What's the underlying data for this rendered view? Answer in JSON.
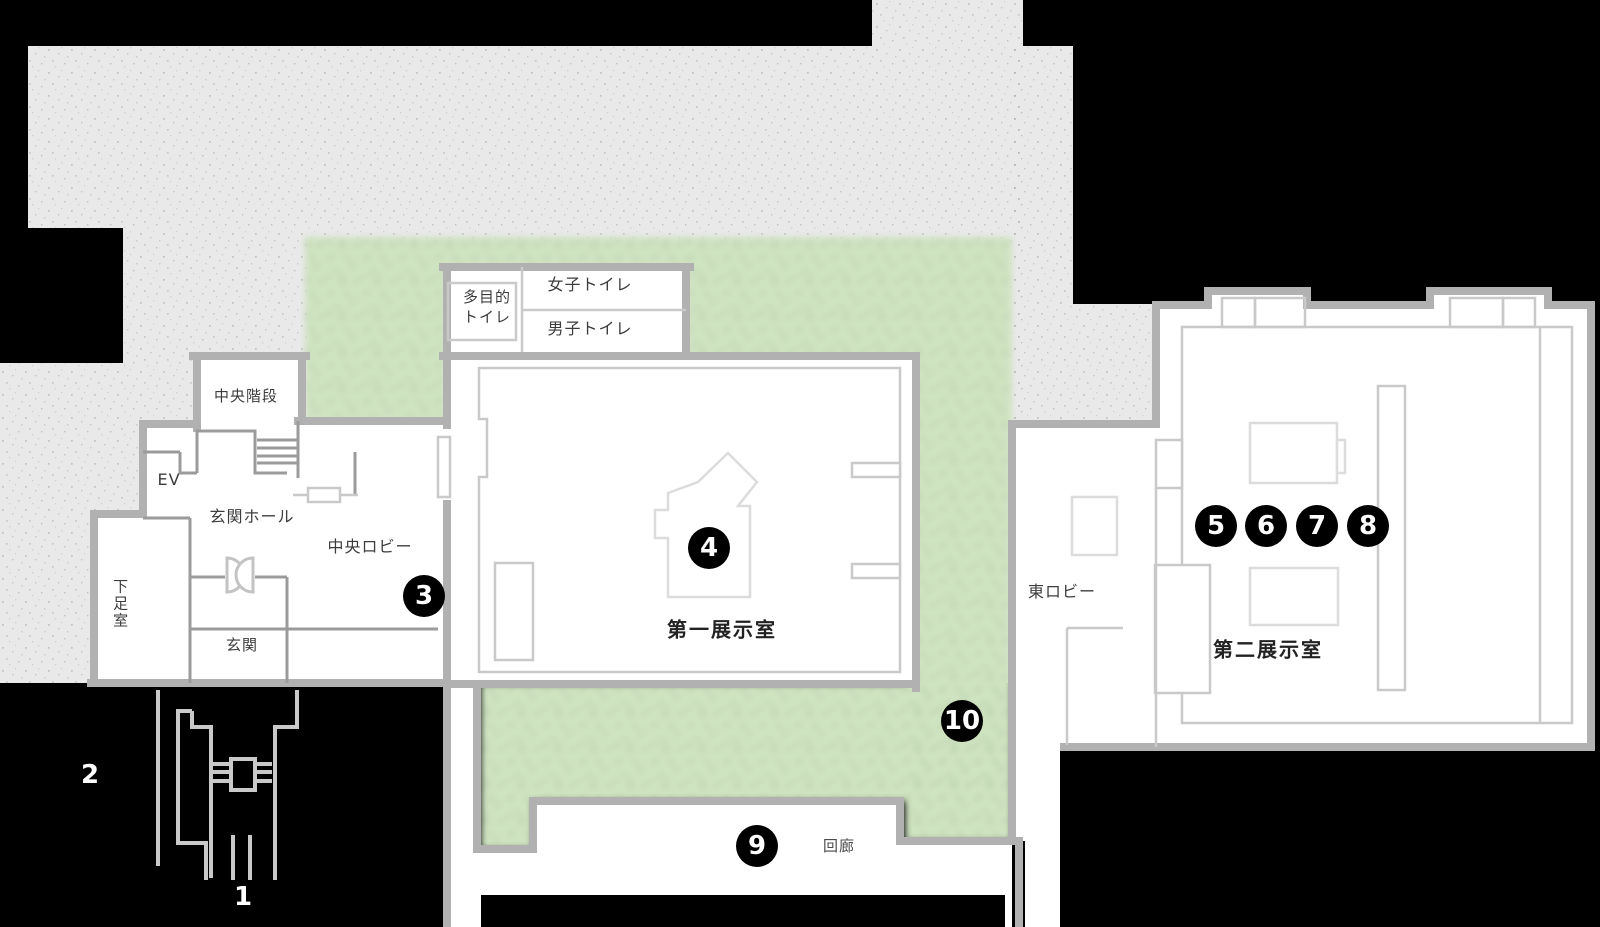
{
  "map": {
    "kind": "museum-floor-plan",
    "colors": {
      "background": "#000000",
      "grounds": "#e9e9e9",
      "garden": "#cfe3c1",
      "wall": "#b1b1b1",
      "thin_wall": "#9b9b9b",
      "light_line": "#d9d9d9",
      "marker_bg": "#000000",
      "marker_text": "#ffffff",
      "label_text": "#3c3c3c"
    }
  },
  "rooms": {
    "multipurpose_toilet": {
      "line1": "多目的",
      "line2": "トイレ"
    },
    "womens_toilet": "女子トイレ",
    "mens_toilet": "男子トイレ",
    "central_stairs": "中央階段",
    "elevator": "EV",
    "entrance_hall": "玄関ホール",
    "shoe_room": "下足室",
    "entrance": "玄関",
    "central_lobby": "中央ロビー",
    "exhibition_room_1": "第一展示室",
    "east_lobby": "東ロビー",
    "exhibition_room_2": "第二展示室",
    "corridor": "回廊"
  },
  "markers": [
    {
      "label": "1",
      "style": "plain"
    },
    {
      "label": "2",
      "style": "plain"
    },
    {
      "label": "3",
      "style": "circle"
    },
    {
      "label": "4",
      "style": "circle"
    },
    {
      "label": "5",
      "style": "circle"
    },
    {
      "label": "6",
      "style": "circle"
    },
    {
      "label": "7",
      "style": "circle"
    },
    {
      "label": "8",
      "style": "circle"
    },
    {
      "label": "9",
      "style": "circle"
    },
    {
      "label": "10",
      "style": "circle"
    }
  ]
}
